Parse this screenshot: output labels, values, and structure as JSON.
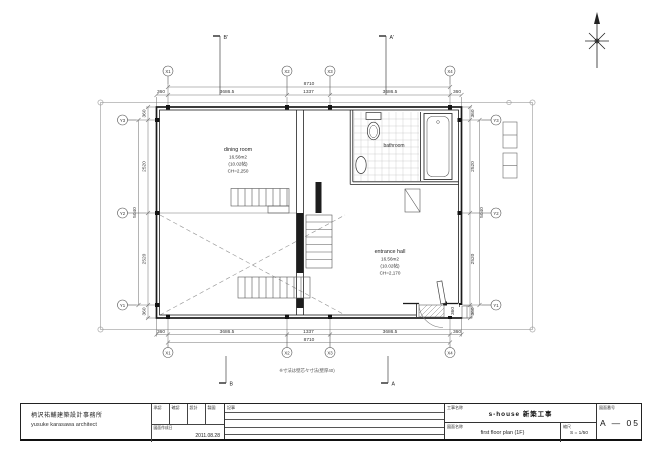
{
  "titleblock": {
    "firm_jp": "柄沢祐輔建築設計事務所",
    "firm_en": "yusuke karasawa architect",
    "stamp_headers": [
      "承認",
      "確認",
      "設計",
      "製図"
    ],
    "date_label": "図面作成日",
    "date": "2011.08.28",
    "notes_label": "記事",
    "project_label": "工事名称",
    "project_name": "s-house 新築工事",
    "drawing_label": "図面名称",
    "drawing_name": "first floor plan (1F)",
    "scale_label": "縮尺",
    "scale_value": "S = 1/50",
    "sheet_label": "図面番号",
    "sheet_number": "A — 05"
  },
  "plan": {
    "grid_x": [
      "X1",
      "X2",
      "X3",
      "X4"
    ],
    "grid_y": [
      "Y3",
      "Y2",
      "Y1"
    ],
    "dim_overall_x": "8710",
    "dim_x": [
      "360",
      "3686.5",
      "1337",
      "3686.5",
      "360"
    ],
    "dim_overall_y": "5040",
    "dim_y": [
      "360",
      "2520",
      "2520",
      "360"
    ],
    "dim_porch": "360",
    "sections": {
      "b_top": "B'",
      "a_top": "A'",
      "b_bottom": "B",
      "a_bottom": "A"
    },
    "note": "※寸法は壁芯々寸法(壁厚40)",
    "rooms": {
      "dining": {
        "name": "dining room",
        "area": "16.56m2",
        "tatami": "(10.02帖)",
        "ch": "CH=2,250"
      },
      "entrance": {
        "name": "entrance hall",
        "area": "16.56m2",
        "tatami": "(10.02帖)",
        "ch": "CH=2,170"
      },
      "bathroom": {
        "name": "bathroom"
      }
    }
  }
}
